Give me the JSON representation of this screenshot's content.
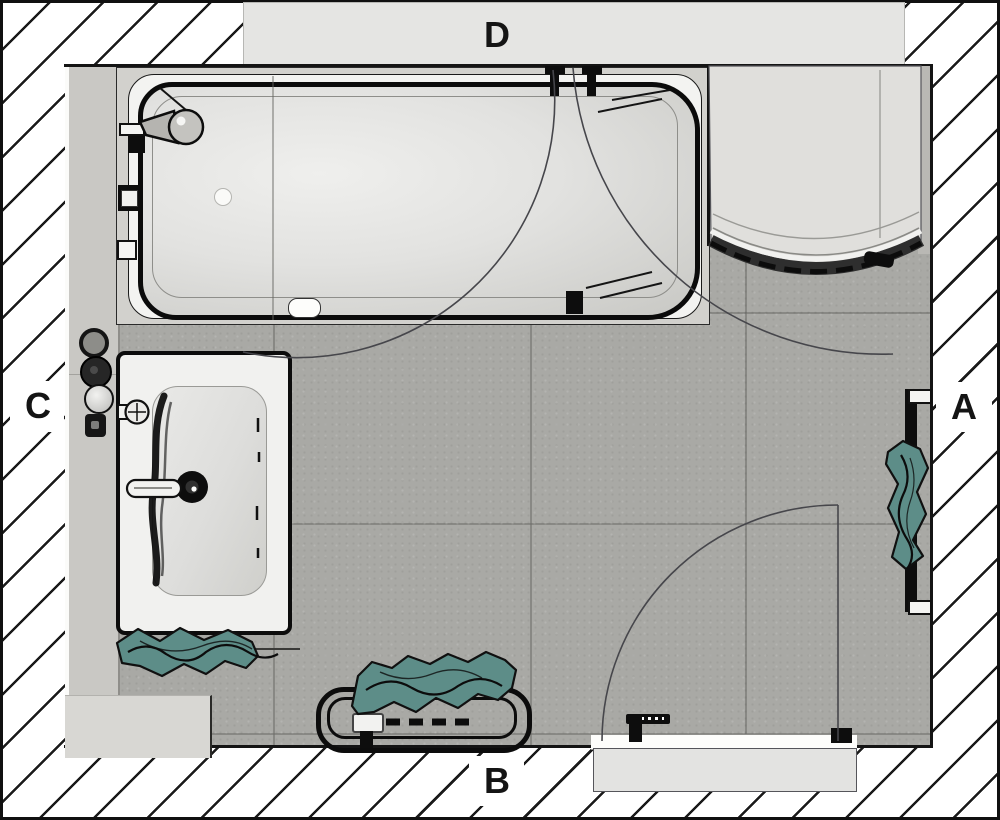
{
  "document": {
    "type": "bathroom-floor-plan-top-view"
  },
  "labels": {
    "a": "A",
    "b": "B",
    "c": "C",
    "d": "D"
  },
  "fixtures": {
    "bathtub": "bathtub",
    "bath_faucet": "bath-faucet",
    "bath_screen": "folding-bath-screen-swing",
    "shower": "quadrant-shower-enclosure",
    "washbasin": "washbasin-vanity",
    "basin_drain": "basin-drain",
    "wall_fittings": "wall-mounted-fittings",
    "towel_radiator": "towel-radiator",
    "towel_rail": "wall-towel-rail",
    "door": "entry-door-with-swing",
    "door_handle": "door-handle",
    "window_band": "window-opening",
    "textiles": "teal-towels-and-textile"
  },
  "colors": {
    "accent_teal": "#5d8d88",
    "floor_gray": "#a9a9a5",
    "hatch_line": "#1a1a1a",
    "fixture_outline": "#0d0d0d",
    "band_gray": "#e5e5e3"
  }
}
